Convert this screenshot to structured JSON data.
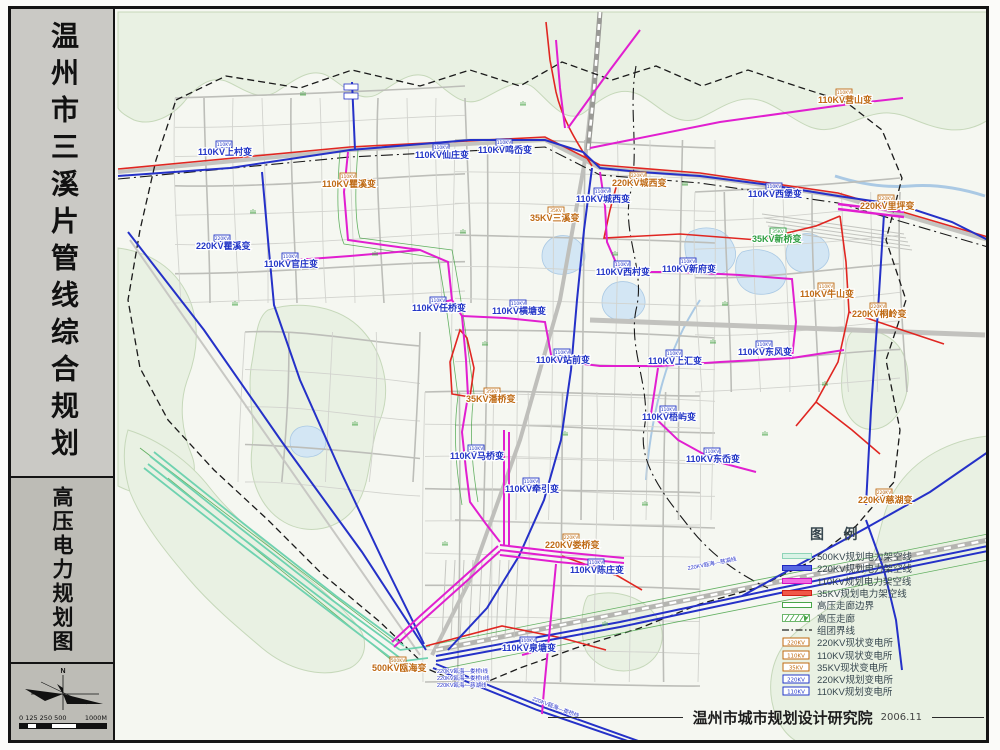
{
  "sidebar": {
    "title_main": "温州市三溪片管线综合规划",
    "title_sub": "高压电力规划图",
    "compass_n": "N",
    "scale_left": "0 125 250 500",
    "scale_right": "1000M"
  },
  "legend": {
    "title": "图  例",
    "items": [
      {
        "kind": "band",
        "fill": "#d9f3e6",
        "edge": "#8fd4b8",
        "label": "500KV规划电力架空线"
      },
      {
        "kind": "band",
        "fill": "#5868e2",
        "edge": "#2028c0",
        "label": "220KV规划电力架空线"
      },
      {
        "kind": "band",
        "fill": "#f26ae2",
        "edge": "#d214c2",
        "label": "110KV规划电力架空线"
      },
      {
        "kind": "band",
        "fill": "#f05848",
        "edge": "#d02018",
        "label": "35KV规划电力架空线"
      },
      {
        "kind": "band",
        "fill": "#ffffff",
        "edge": "#4aa54a",
        "label": "高压走廊边界"
      },
      {
        "kind": "hatch",
        "fill": "#ffffff",
        "edge": "#4aa54a",
        "label": "高压走廊"
      },
      {
        "kind": "dashdot",
        "fill": "#222222",
        "edge": "#222222",
        "label": "组团界线"
      },
      {
        "kind": "box",
        "edge": "#c06a10",
        "text": "220KV",
        "label": "220KV现状变电所"
      },
      {
        "kind": "box",
        "edge": "#c06a10",
        "text": "110KV",
        "label": "110KV现状变电所"
      },
      {
        "kind": "box",
        "edge": "#c06a10",
        "text": "35KV",
        "label": "35KV现状变电所"
      },
      {
        "kind": "box",
        "edge": "#2438c8",
        "text": "220KV",
        "label": "220KV规划变电所"
      },
      {
        "kind": "box",
        "edge": "#2438c8",
        "text": "110KV",
        "label": "110KV规划变电所"
      }
    ]
  },
  "attribution": {
    "org": "温州市城市规划设计研究院",
    "date": "2006.11"
  },
  "colors": {
    "kv500": "#6fd2b0",
    "kv220": "#2531c8",
    "kv110": "#e11fd0",
    "kv35": "#e02621",
    "corridor": "#4aa54a",
    "boundary": "#1a1a1a",
    "label_existing": "#bf6a14",
    "label_planned": "#2336c6",
    "label_green": "#2e9e40",
    "hill_fill": "#e9f1e3",
    "hill_edge": "#c6d8ba",
    "water_fill": "#d3e6f4",
    "water_edge": "#aac9e4",
    "road_minor": "#d2d3ce",
    "road_major": "#bdbeb9",
    "rail": "#9a9a96"
  },
  "map": {
    "substations": [
      {
        "x": 818,
        "y": 103,
        "label": "110KV营山变",
        "type": "existing"
      },
      {
        "x": 322,
        "y": 187,
        "label": "110KV瞿溪变",
        "type": "existing"
      },
      {
        "x": 612,
        "y": 186,
        "label": "220KV城西变",
        "type": "existing"
      },
      {
        "x": 530,
        "y": 221,
        "label": "35KV三溪变",
        "type": "existing"
      },
      {
        "x": 860,
        "y": 209,
        "label": "220KV里坪变",
        "type": "existing"
      },
      {
        "x": 800,
        "y": 297,
        "label": "110KV牛山变",
        "type": "existing"
      },
      {
        "x": 852,
        "y": 317,
        "label": "220KV桐岭变",
        "type": "existing"
      },
      {
        "x": 466,
        "y": 402,
        "label": "35KV潘桥变",
        "type": "existing"
      },
      {
        "x": 545,
        "y": 548,
        "label": "220KV娄桥变",
        "type": "existing"
      },
      {
        "x": 372,
        "y": 671,
        "label": "500KV瓯海变",
        "type": "existing"
      },
      {
        "x": 858,
        "y": 503,
        "label": "220KV慈湖变",
        "type": "existing"
      },
      {
        "x": 752,
        "y": 242,
        "label": "35KV新桥变",
        "type": "green"
      },
      {
        "x": 198,
        "y": 155,
        "label": "110KV上村变",
        "type": "planned"
      },
      {
        "x": 415,
        "y": 158,
        "label": "110KV仙庄变",
        "type": "planned"
      },
      {
        "x": 478,
        "y": 153,
        "label": "110KV鸣岙变",
        "type": "planned"
      },
      {
        "x": 576,
        "y": 202,
        "label": "110KV城西变",
        "type": "planned"
      },
      {
        "x": 196,
        "y": 249,
        "label": "220KV瞿溪变",
        "type": "planned"
      },
      {
        "x": 264,
        "y": 267,
        "label": "110KV官庄变",
        "type": "planned"
      },
      {
        "x": 748,
        "y": 197,
        "label": "110KV西堡变",
        "type": "planned"
      },
      {
        "x": 596,
        "y": 275,
        "label": "110KV西村变",
        "type": "planned"
      },
      {
        "x": 662,
        "y": 272,
        "label": "110KV新府变",
        "type": "planned"
      },
      {
        "x": 412,
        "y": 311,
        "label": "110KV任桥变",
        "type": "planned"
      },
      {
        "x": 492,
        "y": 314,
        "label": "110KV横塘变",
        "type": "planned"
      },
      {
        "x": 536,
        "y": 363,
        "label": "110KV站前变",
        "type": "planned"
      },
      {
        "x": 648,
        "y": 364,
        "label": "110KV上汇变",
        "type": "planned"
      },
      {
        "x": 738,
        "y": 355,
        "label": "110KV东风变",
        "type": "planned"
      },
      {
        "x": 642,
        "y": 420,
        "label": "110KV梧屿变",
        "type": "planned"
      },
      {
        "x": 686,
        "y": 462,
        "label": "110KV东岙变",
        "type": "planned"
      },
      {
        "x": 450,
        "y": 459,
        "label": "110KV马桥变",
        "type": "planned"
      },
      {
        "x": 505,
        "y": 492,
        "label": "110KV牵引变",
        "type": "planned"
      },
      {
        "x": 570,
        "y": 573,
        "label": "110KV陈庄变",
        "type": "planned"
      },
      {
        "x": 502,
        "y": 651,
        "label": "110KV泉塘变",
        "type": "planned"
      }
    ],
    "line_labels": [
      {
        "x": 437,
        "y": 673,
        "rot": 0,
        "text": "220KV瓯海—娄桥I线"
      },
      {
        "x": 437,
        "y": 680,
        "rot": 0,
        "text": "220KV瓯海—娄桥II线"
      },
      {
        "x": 437,
        "y": 687,
        "rot": 0,
        "text": "220KV瓯海—慈湖线"
      },
      {
        "x": 688,
        "y": 570,
        "rot": -11,
        "text": "220KV瓯海—慈湖线"
      },
      {
        "x": 532,
        "y": 700,
        "rot": 21,
        "text": "220KV瓯海—娄桥线"
      }
    ]
  }
}
